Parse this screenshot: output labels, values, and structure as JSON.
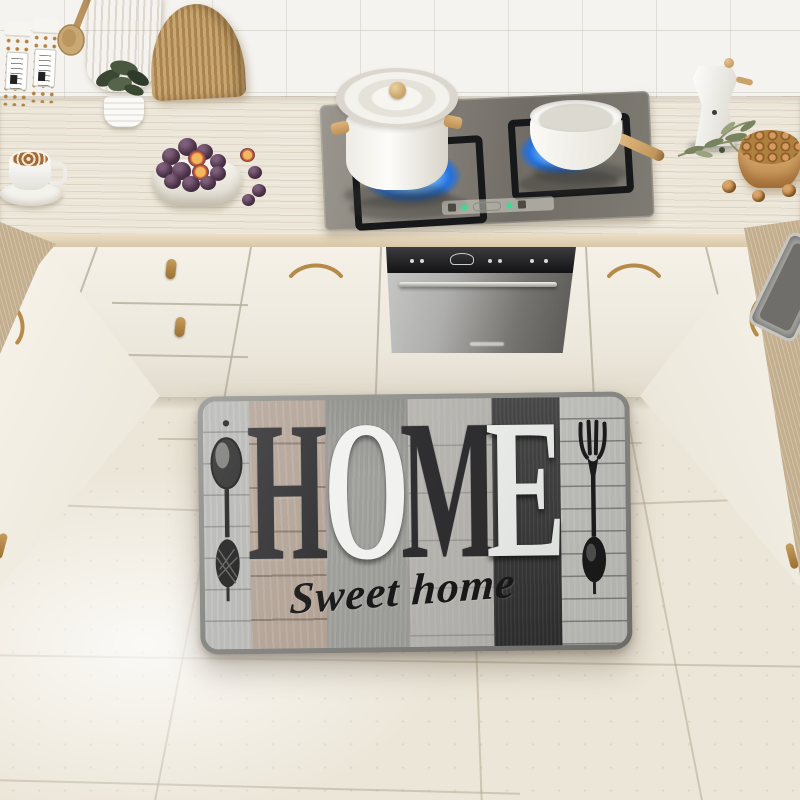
{
  "mat": {
    "word": "HOME",
    "letters": [
      {
        "char": "H",
        "color": "#303032",
        "strip_color": "#b2a295"
      },
      {
        "char": "O",
        "color": "#f1f1ef",
        "strip_color": "#9c9c98"
      },
      {
        "char": "M",
        "color": "#2f2f31",
        "strip_color": "#b7b5b0"
      },
      {
        "char": "E",
        "color": "#eef0ee",
        "strip_color": "#3a3a3a"
      }
    ],
    "script_text": "Sweet home",
    "script_color": "#191919",
    "edge_color": "#83837f",
    "left_strip_color": "#b5b6b3",
    "right_strip_color": "#c4c4c0",
    "icons": [
      "spoon-icon",
      "fork-icon"
    ]
  },
  "palette": {
    "wall_tile": "#f5f3ef",
    "countertop_wood": "#c9b698",
    "cabinet_cream": "#f3efe6",
    "floor_tile": "#ece6d8",
    "stove_glass": "#7d7a72",
    "flame_blue": "#3f8fe8",
    "brass_handle": "#b68a48",
    "fig_purple": "#4c3349",
    "walnut_brown": "#b57a3e",
    "plant_green": "#49583f",
    "oven_panel": "#1c1c1e"
  }
}
